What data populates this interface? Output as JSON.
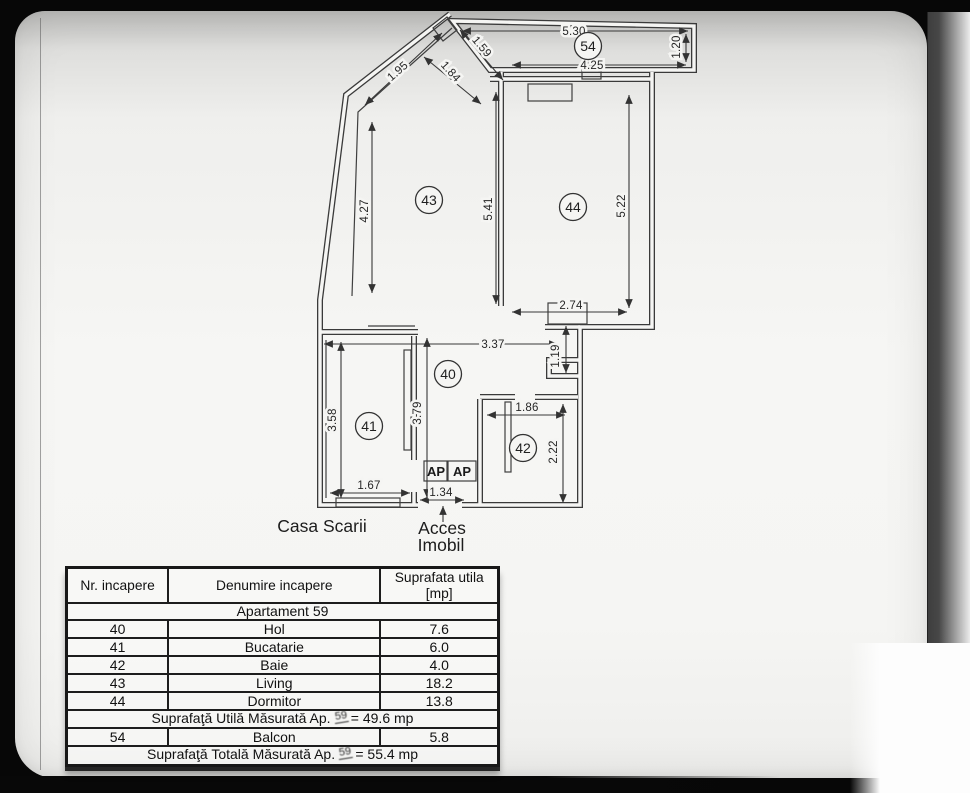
{
  "plan": {
    "rooms": {
      "r54": "54",
      "r43": "43",
      "r44": "44",
      "r40": "40",
      "r41": "41",
      "r42": "42"
    },
    "dims": {
      "d530": "5.30",
      "d425": "4.25",
      "d120": "1.20",
      "d159": "1.59",
      "d184": "1.84",
      "d195": "1.95",
      "d427": "4.27",
      "d541": "5.41",
      "d522": "5.22",
      "d274": "2.74",
      "d337": "3.37",
      "d119": "1.19",
      "d379": "3.79",
      "d358": "3.58",
      "d186": "1.86",
      "d222": "2.22",
      "d167": "1.67",
      "d134": "1.34"
    },
    "labels": {
      "casa_scarii": "Casa Scarii",
      "acces_1": "Acces",
      "acces_2": "Imobil",
      "ap_left": "AP",
      "ap_right": "AP"
    }
  },
  "table": {
    "headers": {
      "col1": "Nr. incapere",
      "col2": "Denumire incapere",
      "col3_line1": "Suprafata utila",
      "col3_line2": "[mp]"
    },
    "group_header": "Apartament 59",
    "rows": [
      {
        "nr": "40",
        "name": "Hol",
        "area": "7.6"
      },
      {
        "nr": "41",
        "name": "Bucatarie",
        "area": "6.0"
      },
      {
        "nr": "42",
        "name": "Baie",
        "area": "4.0"
      },
      {
        "nr": "43",
        "name": "Living",
        "area": "18.2"
      },
      {
        "nr": "44",
        "name": "Dormitor",
        "area": "13.8"
      }
    ],
    "summary_util": {
      "prefix": "Suprafaţă Utilă Măsurată Ap.",
      "ap": "59",
      "suffix": "= 49.6 mp"
    },
    "balcon_row": {
      "nr": "54",
      "name": "Balcon",
      "area": "5.8"
    },
    "summary_total": {
      "prefix": "Suprafaţă Totală Măsurată Ap.",
      "ap": "59",
      "suffix": "= 55.4 mp"
    }
  }
}
